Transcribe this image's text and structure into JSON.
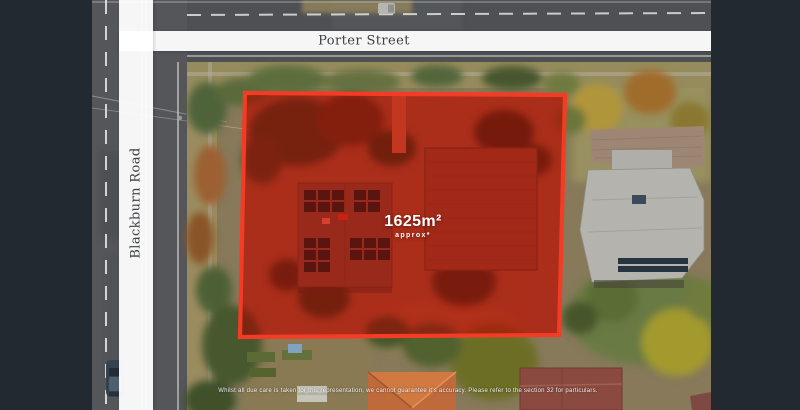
{
  "streets": {
    "porter_label": "Porter Street",
    "blackburn_label": "Blackburn Road"
  },
  "property": {
    "area_value": "1625m²",
    "area_qualifier": "approx*"
  },
  "disclaimer_text": "Whilst all due care is taken for this representation, we cannot guarantee it's accuracy. Please refer to the section 32 for particulars.",
  "colors": {
    "boundary_stroke": "#f43b25",
    "boundary_fill": "#ff4530",
    "boundary_glow": "rgba(255,45,22,0.30)",
    "letterbox": "#232931",
    "street_band": "rgba(255,255,255,0.95)",
    "street_text": "#3d4044",
    "area_text": "#ffffff"
  }
}
